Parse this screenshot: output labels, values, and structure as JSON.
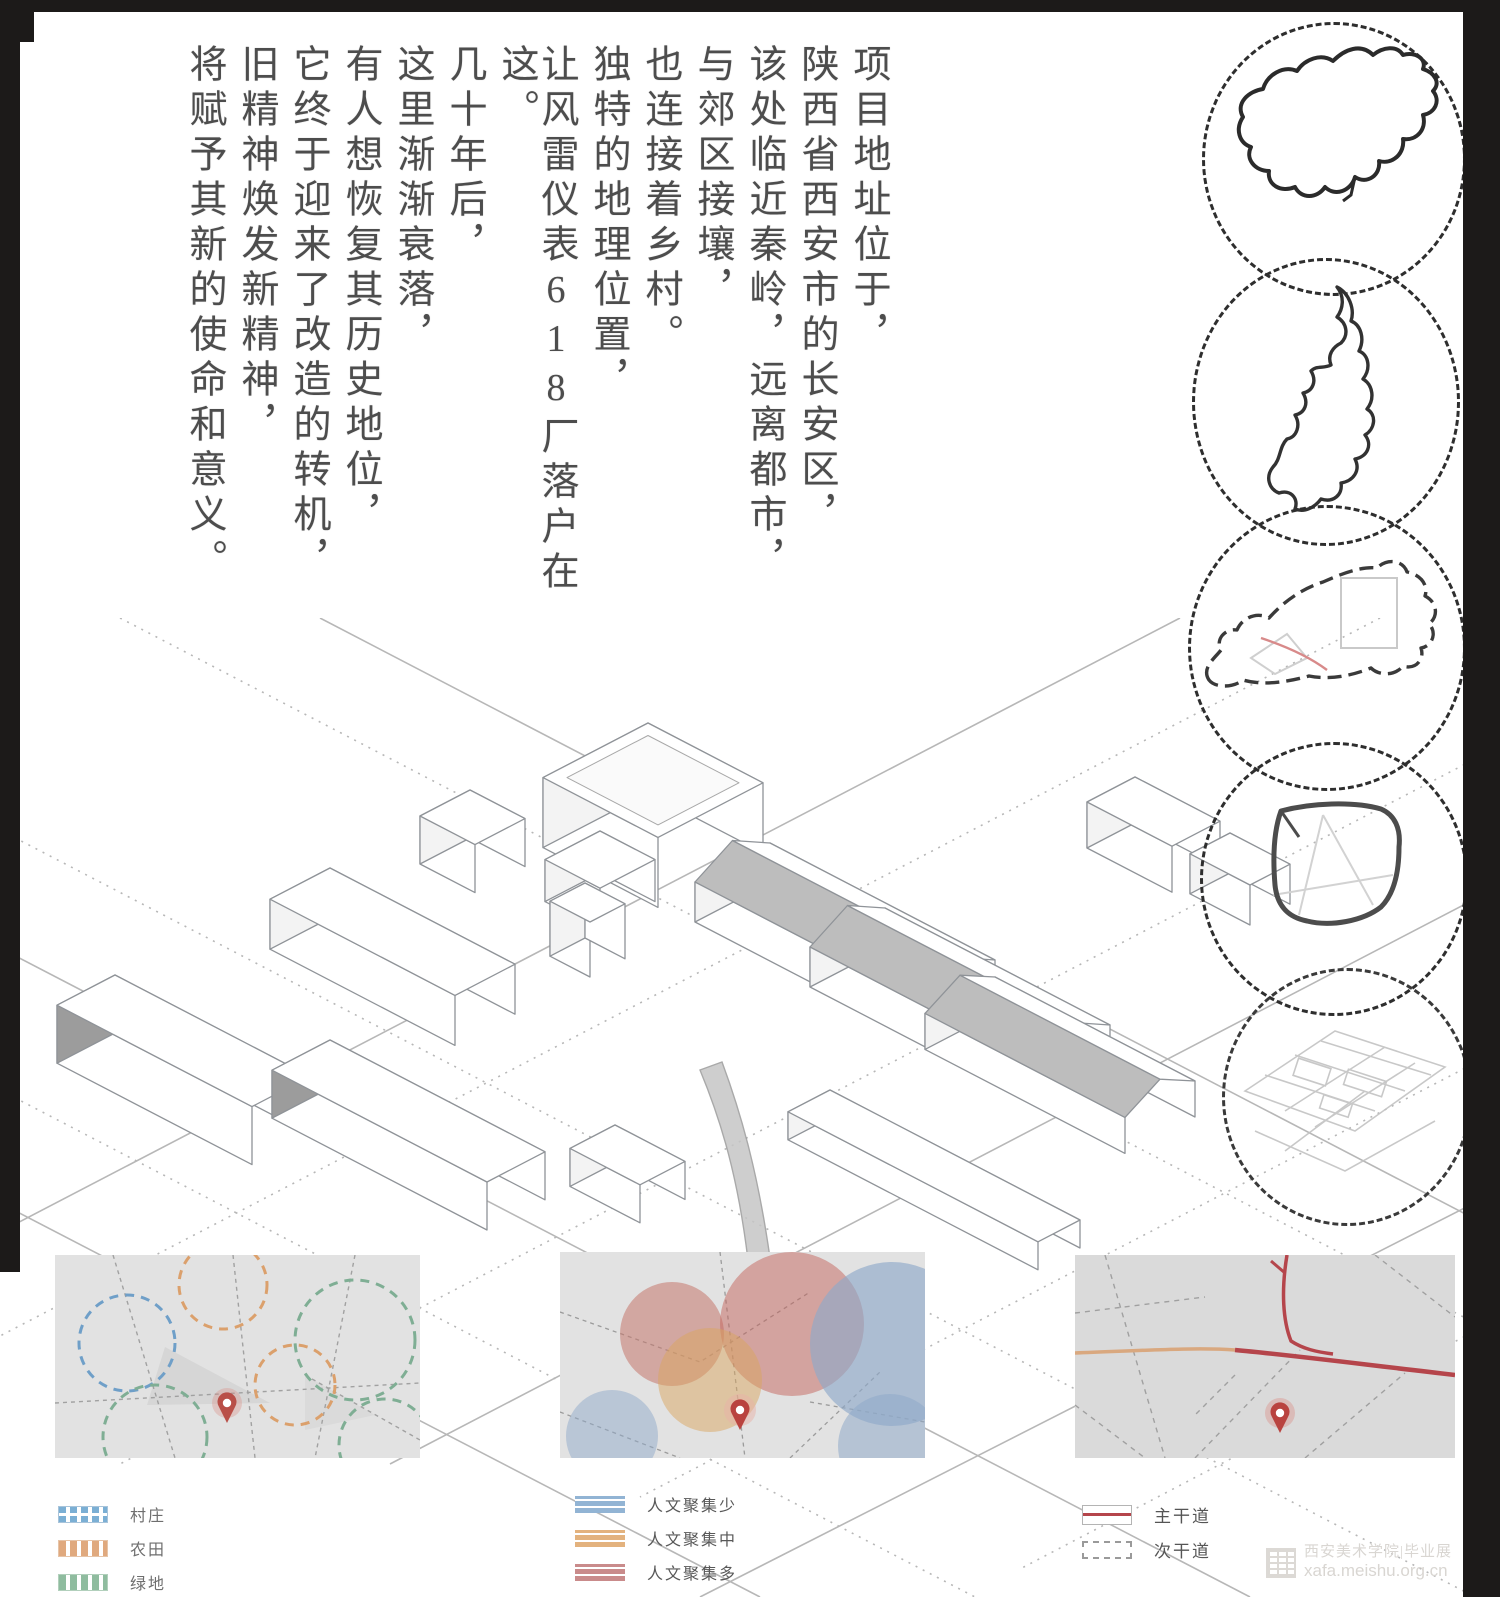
{
  "intro_text": {
    "columns": [
      "项目地址位于，",
      "陕西省西安市的长安区，",
      "该处临近秦岭，远离都市，",
      "与郊区接壤，",
      "也连接着乡村。",
      "独特的地理位置，",
      "让风雷仪表618厂落户在这。",
      "几十年后，",
      "这里渐渐衰落，",
      "有人想恢复其历史地位，",
      "它终于迎来了改造的转机，",
      "旧精神焕发新精神，",
      "将赋予其新的使命和意义。"
    ]
  },
  "location_chain": {
    "items": [
      {
        "name": "china-outline-map"
      },
      {
        "name": "shaanxi-province-outline-map"
      },
      {
        "name": "xian-city-outline-map"
      },
      {
        "name": "changan-district-outline-map"
      },
      {
        "name": "site-aerial-sketch"
      }
    ]
  },
  "site_maps": [
    {
      "id": "surrounding-landuse-map",
      "legend": [
        {
          "color": "#7bafd4",
          "label": "村庄"
        },
        {
          "color": "#e0a97e",
          "label": "农田"
        },
        {
          "color": "#8fbc9f",
          "label": "绿地"
        }
      ]
    },
    {
      "id": "crowd-density-map",
      "legend": [
        {
          "color": "#92b4d4",
          "label": "人文聚集少"
        },
        {
          "color": "#e3b27e",
          "label": "人文聚集中"
        },
        {
          "color": "#c98b8b",
          "label": "人文聚集多"
        }
      ]
    },
    {
      "id": "road-network-map",
      "legend": [
        {
          "color": "#b5454b",
          "label": "主干道"
        },
        {
          "color": "#9a9a9a",
          "label": "次干道"
        }
      ]
    }
  ],
  "watermark": {
    "line1": "西安美术学院|毕业展",
    "line2": "xafa.meishu.org.cn",
    "color": "#d9d6d2"
  },
  "accent_colors": {
    "pin_red": "#b94f48",
    "road_red": "#b5454b",
    "map_bg_gray": "#e2e2e2",
    "sketch_gray": "#8f9398"
  }
}
